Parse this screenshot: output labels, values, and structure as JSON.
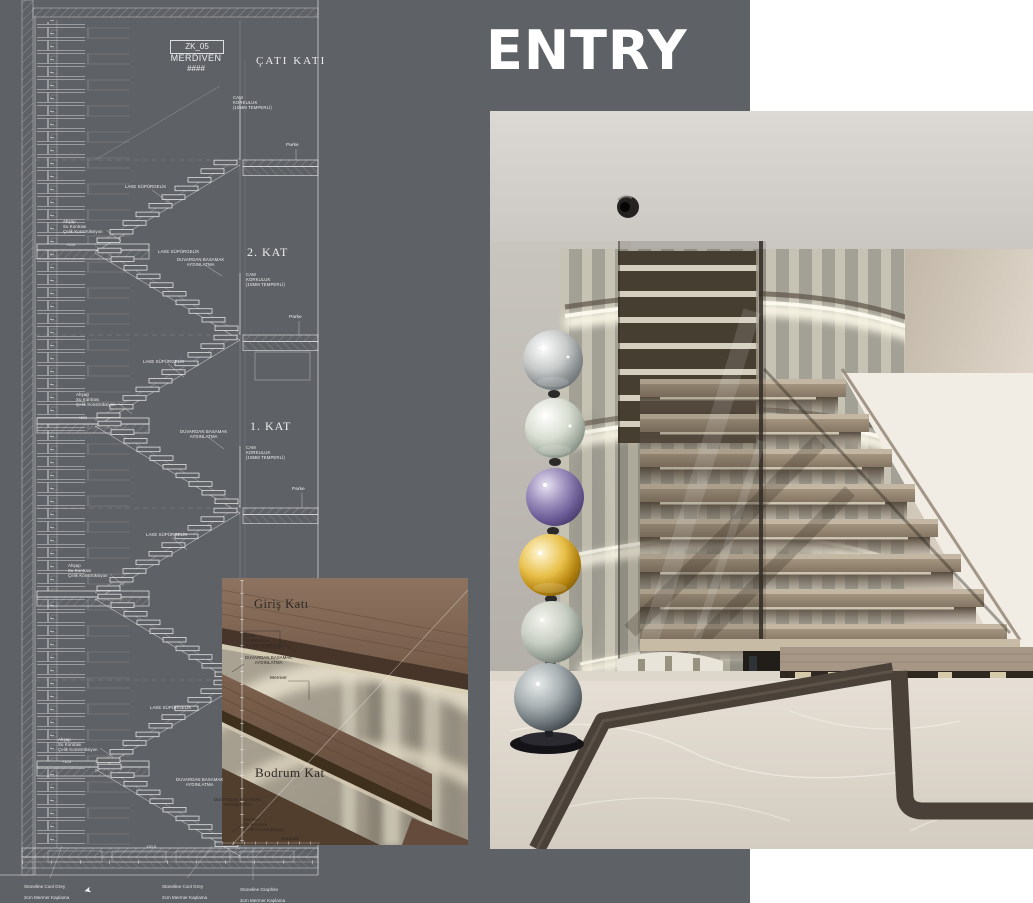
{
  "page": {
    "title": "ENTRY"
  },
  "colors": {
    "panel_gray": "#5e6165",
    "cad_line": "#eceded",
    "wood_tread": "#8d7260",
    "marble_floor": "#ddd6cb",
    "marble_inlay": "#4a4138",
    "sphere_chrome": "#c7c9c9",
    "sphere_celadon": "#a9b2a6",
    "sphere_purple": "#6a5a96",
    "sphere_gold": "#c9971c",
    "sphere_smoke": "#6b7478"
  },
  "cad": {
    "title_block": {
      "code": "ZK_05",
      "name": "MERDIVEN",
      "sheet_no": "####"
    },
    "floors": [
      {
        "label": "ÇATI KATI"
      },
      {
        "label": "2. KAT"
      },
      {
        "label": "1. KAT"
      },
      {
        "label": "Giriş Katı"
      },
      {
        "label": "Bodrum Kat"
      }
    ],
    "annotations": {
      "skirting": "LAKE SÜPÜRGELİK",
      "glass_railing": "CAM\nKORKULUK\n(10MM TEMPERLİ)",
      "step_lighting": "DUVARDAN BASAMAK\nAYDINLATMA",
      "wood_structure": "Ahşap\nSu Kontrası\nÇelik Konstrüksiyon",
      "marble_structure": "Mermer\nSu Kontrası\nÇelik Konstrüksiyon",
      "parquet": "Parke",
      "marble": "Mermer",
      "ceramic": "Seramik",
      "elevation_mark": "+103",
      "dimension": "130,5"
    },
    "material_captions": [
      {
        "line1": "Stoneline Cool Grey",
        "line2": "2cm Mermer Kaplama"
      },
      {
        "line1": "Stoneline Cool Grey",
        "line2": "2cm Mermer Kaplama"
      },
      {
        "line1": "Stoneline Graphite",
        "line2": "2cm Mermer Kaplama"
      }
    ]
  }
}
